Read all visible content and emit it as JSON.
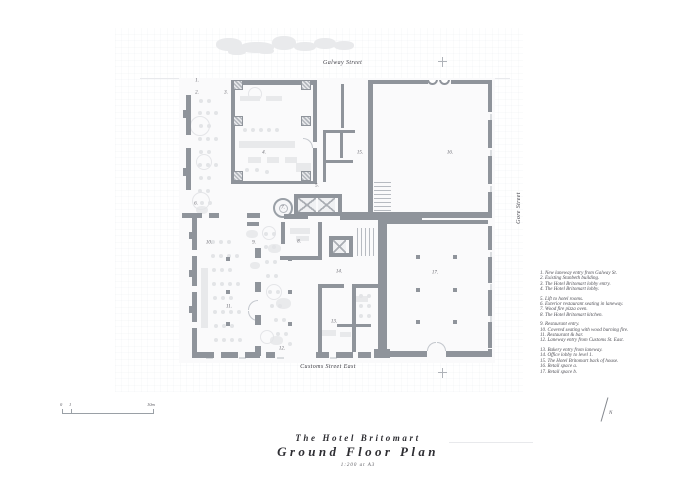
{
  "streets": {
    "top": "Galway Street",
    "right": "Gore Street",
    "bottom": "Customs Street East"
  },
  "title_block": {
    "hotel": "The Hotel Britomart",
    "drawing": "Ground Floor Plan",
    "scale": "1:200 at A3"
  },
  "scale_bar": {
    "tick_zero": "0",
    "tick_one": "1",
    "tick_end": "10m"
  },
  "north_label": "N",
  "legend": {
    "groups": [
      [
        "1. New laneway entry from Galway St.",
        "2. Existing Stanbeth building.",
        "3. The Hotel Britomart lobby entry.",
        "4. The Hotel Britomart lobby."
      ],
      [
        "5. Lift to hotel rooms.",
        "6. Exterior restaurant seating in laneway.",
        "7. Wood fire pizza oven.",
        "8. The Hotel Britomart kitchen."
      ],
      [
        "9. Restaurant entry.",
        "10. Covered seating with wood burning fire.",
        "11. Restaurant & bar.",
        "12. Laneway entry from Customs St. East."
      ],
      [
        "13. Bakery entry from laneway.",
        "14. Office lobby to level 1.",
        "15. The Hotel Britomart back of house.",
        "16. Retail space a.",
        "17. Retail space b."
      ]
    ]
  },
  "plan": {
    "rooms": [
      {
        "num": "1.",
        "x": 197,
        "y": 81
      },
      {
        "num": "2.",
        "x": 197,
        "y": 93
      },
      {
        "num": "3.",
        "x": 226,
        "y": 93
      },
      {
        "num": "4.",
        "x": 264,
        "y": 153
      },
      {
        "num": "5.",
        "x": 317,
        "y": 186
      },
      {
        "num": "6.",
        "x": 196,
        "y": 204
      },
      {
        "num": "7.",
        "x": 283,
        "y": 208
      },
      {
        "num": "8.",
        "x": 299,
        "y": 242
      },
      {
        "num": "9.",
        "x": 254,
        "y": 243
      },
      {
        "num": "10.",
        "x": 209,
        "y": 243
      },
      {
        "num": "11.",
        "x": 229,
        "y": 307
      },
      {
        "num": "12.",
        "x": 282,
        "y": 349
      },
      {
        "num": "13.",
        "x": 334,
        "y": 322
      },
      {
        "num": "14.",
        "x": 339,
        "y": 272
      },
      {
        "num": "15.",
        "x": 360,
        "y": 153
      },
      {
        "num": "16.",
        "x": 450,
        "y": 153
      },
      {
        "num": "17.",
        "x": 435,
        "y": 273
      }
    ]
  },
  "colors": {
    "wall": "#8f949b",
    "light_wall": "#c9cdd2",
    "legend_text": "#4e4e55",
    "title_text": "#2e2e33"
  }
}
